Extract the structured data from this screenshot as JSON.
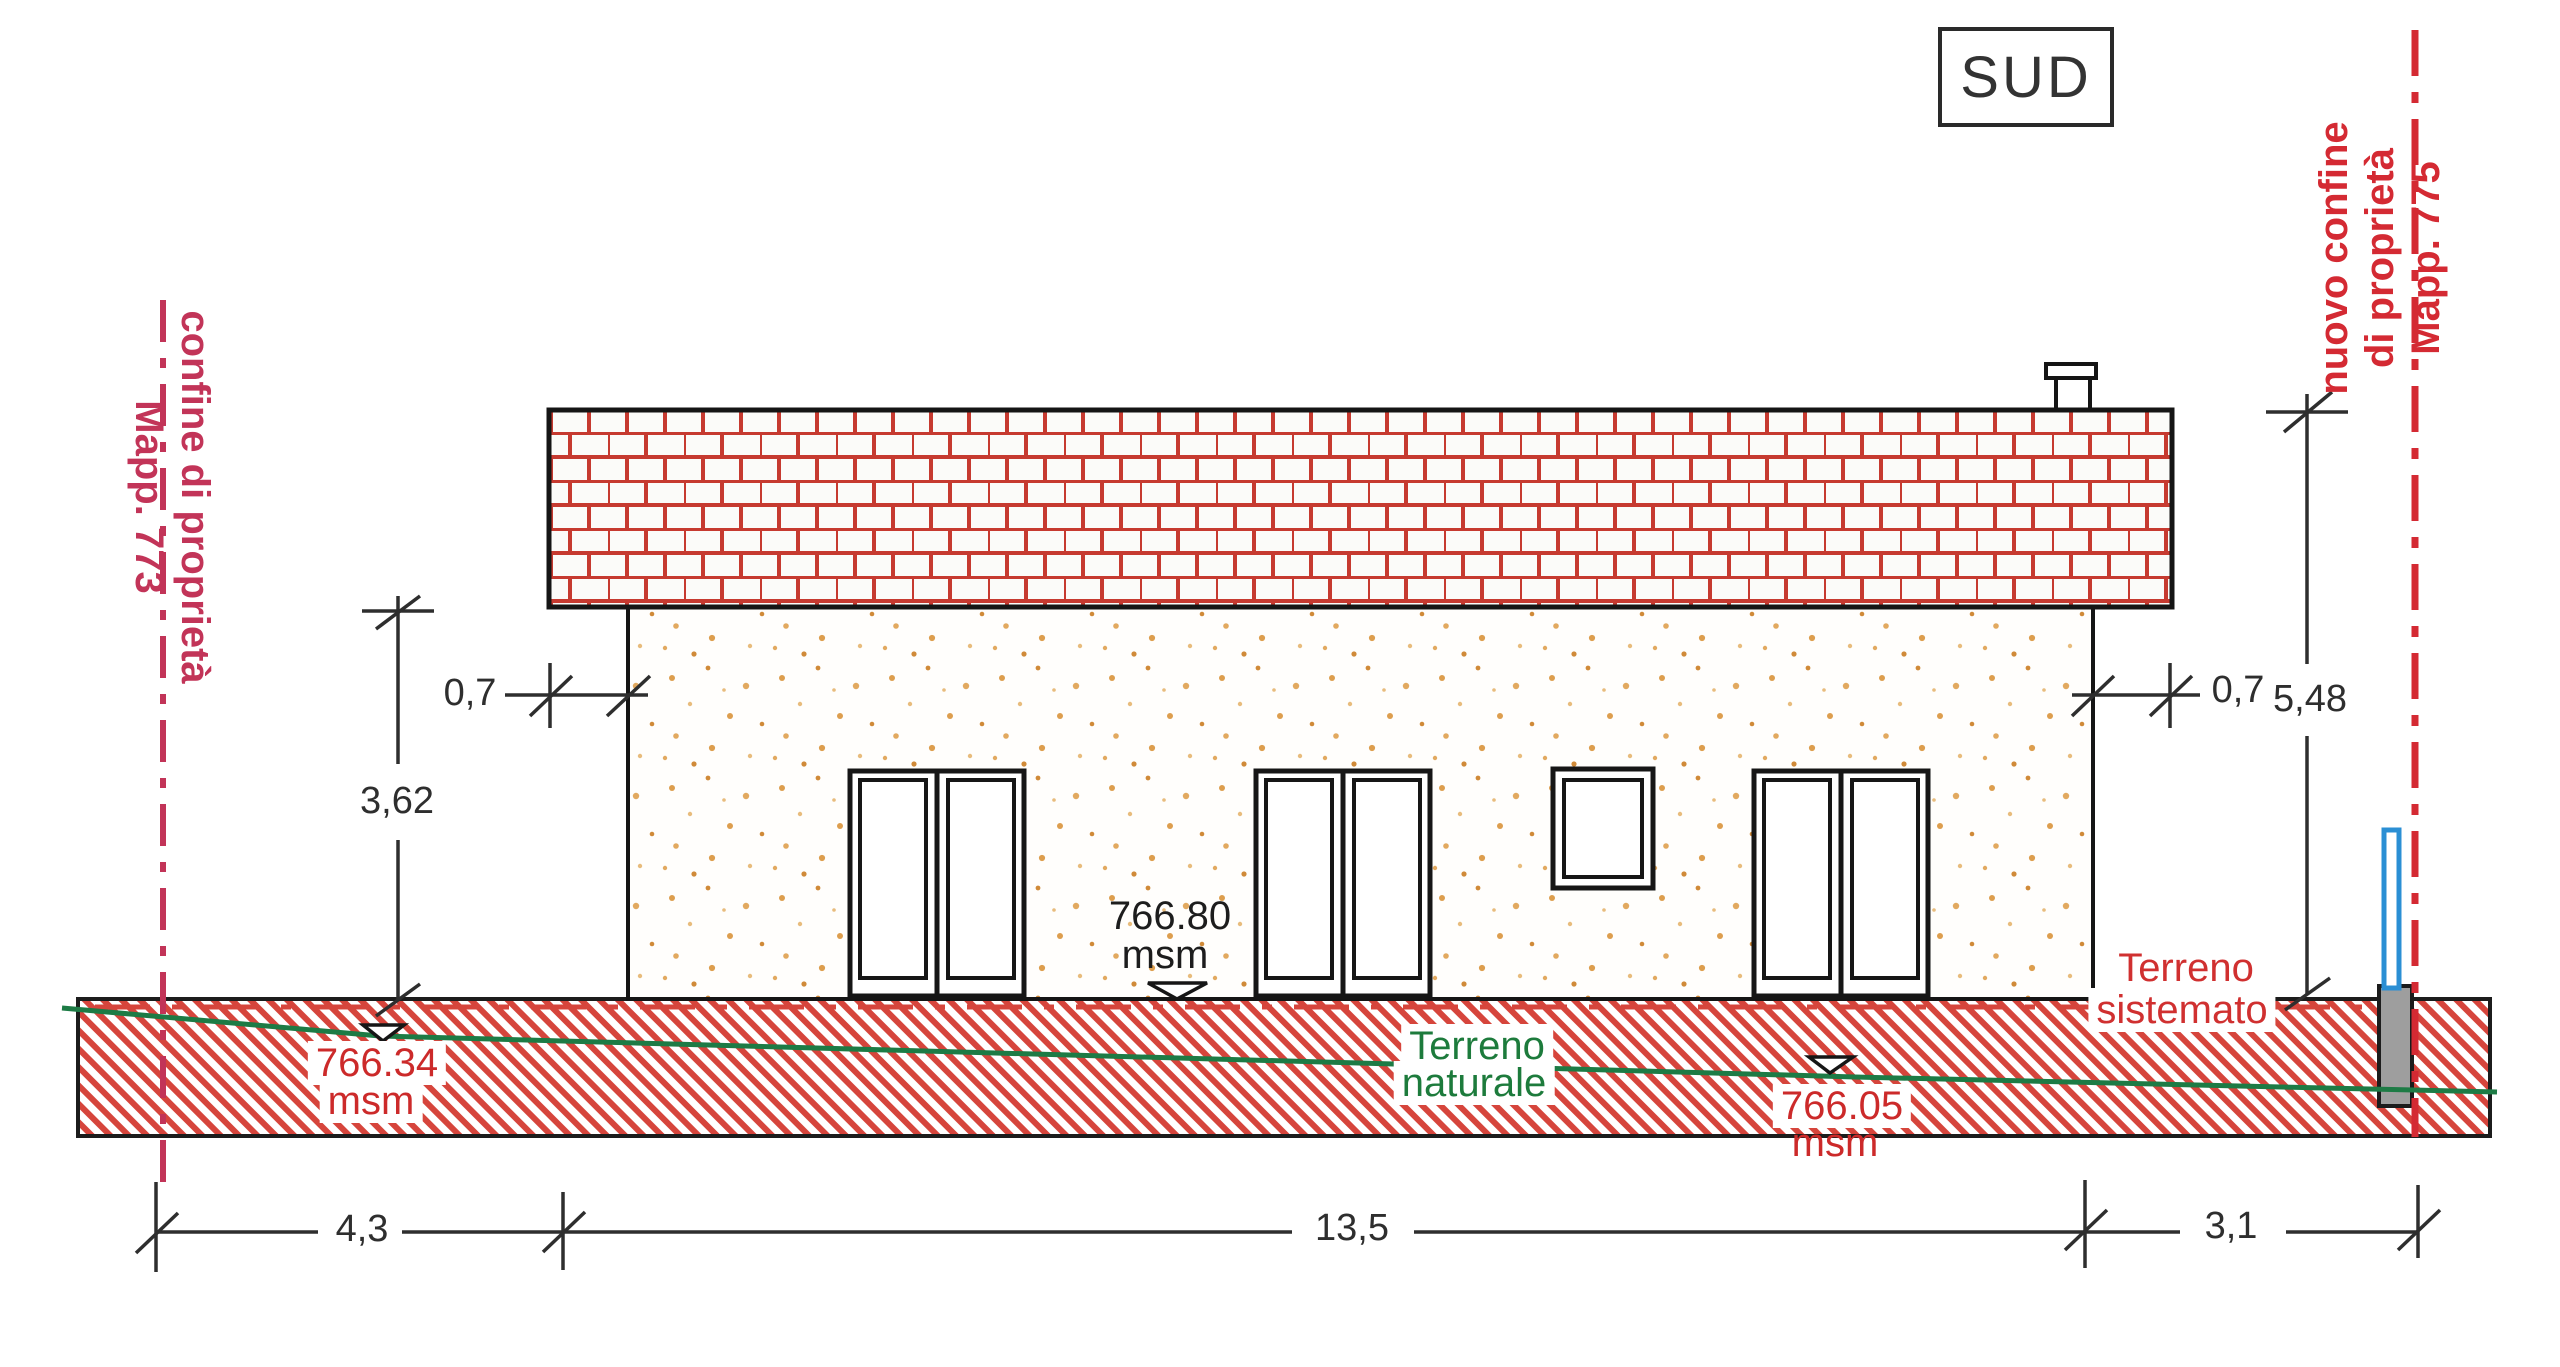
{
  "orientation_label": "SUD",
  "boundary_left": {
    "name": "confine di proprietà",
    "parcel": "Mapp. 773"
  },
  "boundary_right": {
    "name_line1": "nuovo confine",
    "name_line2": "di proprietà",
    "parcel": "Mapp. 775"
  },
  "levels": {
    "floor": {
      "value": "766.80",
      "unit": "msm"
    },
    "terrain_left": {
      "value": "766.34",
      "unit": "msm"
    },
    "terrain_mid": {
      "value": "766.05",
      "unit": "msm"
    }
  },
  "terrain_labels": {
    "natural_line1": "Terreno",
    "natural_line2": "naturale",
    "arranged_line1": "Terreno",
    "arranged_line2": "sistemato"
  },
  "dimensions": {
    "eave_overhang_left": "0,7",
    "eave_overhang_right": "0,7",
    "wall_height": "3,62",
    "total_height": "5,48",
    "distance_left_boundary": "4,3",
    "building_length": "13,5",
    "distance_right_boundary": "3,1"
  },
  "colors": {
    "boundary_left_line": "#c23458",
    "boundary_right_line": "#d42a33",
    "terrain_hatch_red": "#d6453c",
    "natural_terrain_green": "#1d7b45",
    "annotation_red": "#cc2a2a",
    "brick_joint_red": "#c63a30",
    "marker_post_blue": "#2b8fd4"
  }
}
